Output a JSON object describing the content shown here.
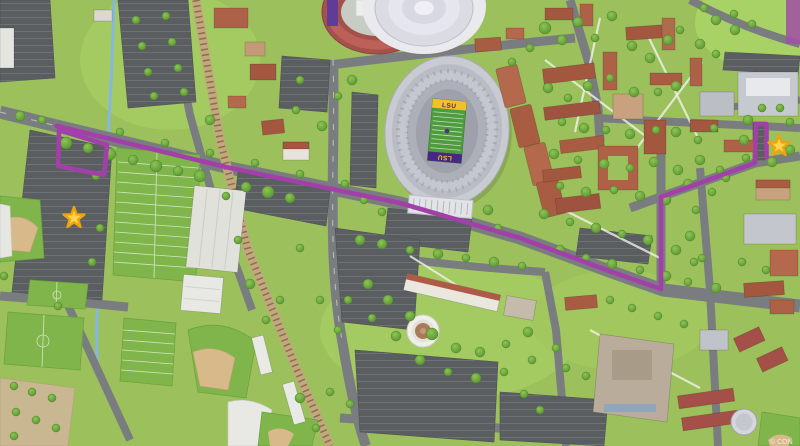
{
  "map": {
    "title": "LSU Campus Map",
    "watermark": "© CON",
    "route": {
      "color": "#A23FA8",
      "main_path": "M57,126 L230,168 L400,203 L520,238 L612,272 L661,289 L661,197 L755,163 L756,124 L766.5,124 L766.5,157",
      "parking_loop_west_path": "M59,130 L107,145 L104,175 L58,166 Z"
    },
    "markers": {
      "start_transform": "translate(74,218)",
      "end_transform": "translate(779,146)"
    },
    "tiger_stadium": {
      "endzone_top": "LSU",
      "endzone_bottom": "LSU"
    },
    "colors": {
      "route": "#A23FA8",
      "star_fill": "#FFD34D",
      "star_stroke": "#F0A30A",
      "grass": "#9CC05B",
      "parking": "#5A5E61",
      "road": "#7A7D80",
      "turf": "#7FB54B",
      "track": "#A5514B",
      "endzone_gold": "#F3C02C",
      "endzone_purple": "#482683"
    },
    "landmarks": [
      "tiger-stadium",
      "track-stadium",
      "assembly-center-dome",
      "practice-fields",
      "indoor-practice-facility",
      "soccer-fields",
      "softball-field",
      "baseball-stadium",
      "rotunda-building",
      "engineering-complex",
      "student-union",
      "quad-buildings",
      "railroad",
      "creek",
      "parade-ground"
    ]
  }
}
